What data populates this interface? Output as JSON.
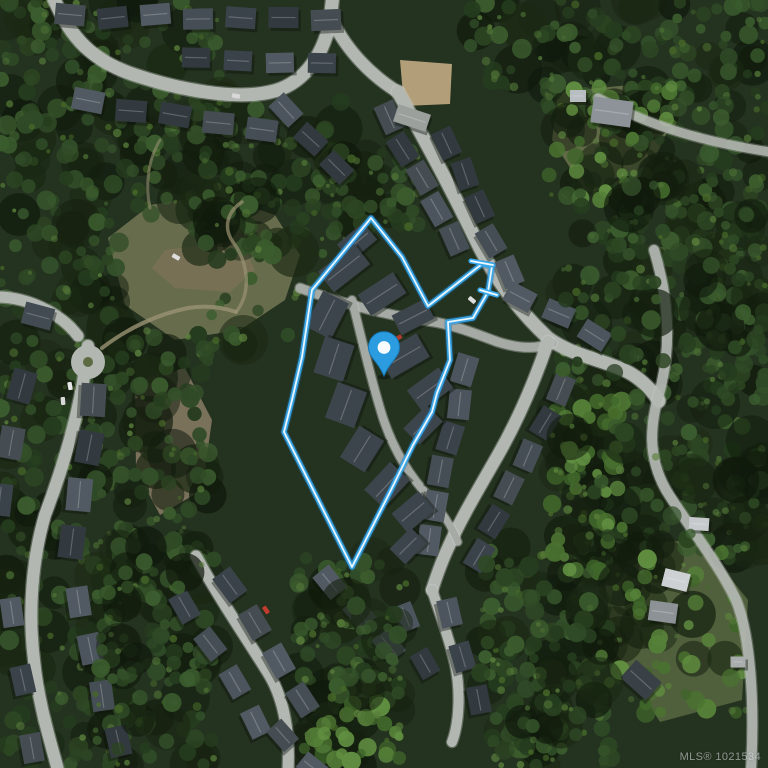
{
  "meta": {
    "width": 768,
    "height": 768,
    "view": "satellite"
  },
  "watermark": {
    "text": "MLS® 1021534"
  },
  "map": {
    "palette": {
      "forest_base": "#243220",
      "road": "#b3b7b2",
      "road_curb": "#d2d5d0",
      "lane": "#a6aaa5",
      "trail": "#9a9274",
      "boundary_outer": "#39a8ea",
      "boundary_halo": "#1d6fa8",
      "boundary_inner": "#f2fbff",
      "pin_fill": "#2b9ce0",
      "pin_stroke": "#1779b6",
      "pin_dot": "#ffffff"
    },
    "forest": {
      "dark_shades": [
        "#2c4522",
        "#34512a",
        "#253c1e",
        "#3b5c2e",
        "#2f4a26"
      ],
      "blob_shades": [
        "#15200f",
        "#1a2813",
        "#101a0c"
      ],
      "light_shades": [
        "#4d7034",
        "#5a7f3c",
        "#466828"
      ],
      "bright_shades": [
        "#4a7230",
        "#558038",
        "#3f652a",
        "#618f41"
      ],
      "regions": [
        {
          "x": 0,
          "y": 0,
          "w": 220,
          "h": 215,
          "n": 120,
          "p": "dark",
          "seed": 11
        },
        {
          "x": 195,
          "y": 95,
          "w": 150,
          "h": 165,
          "n": 70,
          "p": "dark",
          "seed": 12
        },
        {
          "x": 330,
          "y": 150,
          "w": 90,
          "h": 80,
          "n": 30,
          "p": "dark",
          "seed": 13
        },
        {
          "x": 470,
          "y": 0,
          "w": 298,
          "h": 110,
          "n": 90,
          "p": "dark",
          "seed": 14
        },
        {
          "x": 600,
          "y": 100,
          "w": 168,
          "h": 160,
          "n": 60,
          "p": "dark",
          "seed": 15
        },
        {
          "x": 560,
          "y": 170,
          "w": 208,
          "h": 390,
          "n": 170,
          "p": "dark",
          "seed": 16
        },
        {
          "x": 0,
          "y": 215,
          "w": 120,
          "h": 270,
          "n": 80,
          "p": "dark",
          "seed": 17
        },
        {
          "x": 120,
          "y": 330,
          "w": 90,
          "h": 230,
          "n": 55,
          "p": "dark",
          "seed": 18
        },
        {
          "x": 0,
          "y": 480,
          "w": 110,
          "h": 288,
          "n": 60,
          "p": "dark",
          "seed": 19
        },
        {
          "x": 95,
          "y": 540,
          "w": 120,
          "h": 228,
          "n": 85,
          "p": "dark",
          "seed": 20
        },
        {
          "x": 290,
          "y": 555,
          "w": 120,
          "h": 160,
          "n": 60,
          "p": "dark",
          "seed": 21
        },
        {
          "x": 480,
          "y": 545,
          "w": 140,
          "h": 223,
          "n": 90,
          "p": "dark",
          "seed": 22
        },
        {
          "x": 700,
          "y": 250,
          "w": 68,
          "h": 300,
          "n": 42,
          "p": "dark",
          "seed": 23
        },
        {
          "x": 200,
          "y": 190,
          "w": 120,
          "h": 160,
          "n": 22,
          "p": "dark",
          "seed": 24
        },
        {
          "x": 550,
          "y": 395,
          "w": 75,
          "h": 180,
          "n": 45,
          "p": "bright",
          "seed": 25
        },
        {
          "x": 300,
          "y": 700,
          "w": 100,
          "h": 68,
          "n": 26,
          "p": "bright",
          "seed": 26
        },
        {
          "x": 600,
          "y": 540,
          "w": 150,
          "h": 180,
          "n": 40,
          "p": "bright",
          "seed": 27
        },
        {
          "x": 545,
          "y": 80,
          "w": 130,
          "h": 120,
          "n": 28,
          "p": "bright",
          "seed": 28
        }
      ],
      "late_regions": [
        {
          "x": 560,
          "y": 180,
          "w": 200,
          "h": 360,
          "n": 40,
          "p": "dark",
          "seed": 31
        },
        {
          "x": 95,
          "y": 545,
          "w": 110,
          "h": 220,
          "n": 25,
          "p": "dark",
          "seed": 32
        },
        {
          "x": 480,
          "y": 560,
          "w": 130,
          "h": 200,
          "n": 30,
          "p": "dark",
          "seed": 33
        },
        {
          "x": 330,
          "y": 590,
          "w": 70,
          "h": 110,
          "n": 16,
          "p": "dark",
          "seed": 34
        }
      ]
    },
    "clearings": [
      {
        "points": "108,238 150,205 215,195 275,215 300,255 285,300 240,330 175,340 125,305",
        "fill": "#6e7150",
        "opacity": 0.92
      },
      {
        "points": "165,250 240,240 255,270 230,292 175,288 152,268",
        "fill": "#7c7257",
        "opacity": 0.75
      },
      {
        "points": "135,380 185,368 212,420 202,490 160,515 136,470",
        "fill": "#8a7d66",
        "opacity": 0.85
      },
      {
        "points": "600,545 700,540 748,600 742,700 660,722 614,650",
        "fill": "#5d6c43",
        "opacity": 0.8
      },
      {
        "points": "558,92 640,84 668,130 642,186 586,192 552,140",
        "fill": "#6b744d",
        "opacity": 0.85
      },
      {
        "points": "400,60 452,64 450,104 404,106",
        "fill": "#c2ab83",
        "opacity": 0.9
      }
    ],
    "trails": [
      {
        "d": "M 102,348 C 128,328 158,314 188,308 C 206,305 222,307 236,312",
        "w": 4,
        "o": 0.8
      },
      {
        "d": "M 236,312 C 252,292 248,262 233,242 C 223,228 227,212 242,202",
        "w": 3.5,
        "o": 0.7
      },
      {
        "d": "M 150,208 C 145,185 148,160 160,140",
        "w": 3,
        "o": 0.55
      }
    ],
    "roads": [
      {
        "d": "M 52,-6 C 70,40 95,62 135,75 C 180,90 235,100 270,92 C 300,86 322,60 330,22 L 333,-6",
        "w": 13
      },
      {
        "d": "M 333,22 C 348,52 372,76 398,92",
        "w": 12
      },
      {
        "d": "M 398,92 C 425,140 452,190 474,236 C 494,278 518,310 548,338 C 572,356 605,360 628,372 C 641,379 651,389 659,401",
        "w": 13
      },
      {
        "d": "M 300,288 C 345,305 392,316 428,321 C 452,324 476,334 498,342 C 520,349 538,349 552,343",
        "w": 9,
        "lane": true
      },
      {
        "d": "M 548,342 C 535,380 518,420 498,455 C 478,490 460,520 448,548 C 440,565 436,578 432,590",
        "w": 12
      },
      {
        "d": "M 432,590 C 440,614 449,638 455,664 C 461,692 459,724 452,742",
        "w": 10
      },
      {
        "d": "M 654,250 C 668,296 672,344 660,390 C 650,424 647,456 666,490 C 688,526 718,562 736,600 C 750,634 755,700 751,770",
        "w": 10,
        "o": 0.9
      },
      {
        "d": "M 598,98 C 642,122 692,140 770,152",
        "w": 9,
        "o": 0.85
      },
      {
        "d": "M 0,297 C 25,298 58,310 78,336",
        "w": 11
      },
      {
        "d": "M 88,346 C 82,408 62,470 45,515 C 32,560 28,612 34,660 C 38,702 50,740 58,770",
        "w": 12
      },
      {
        "d": "M 196,556 C 220,600 248,640 270,676 C 284,700 290,734 288,770",
        "w": 11
      },
      {
        "d": "M 352,300 C 362,340 371,380 383,418 C 393,448 409,476 431,499",
        "w": 8,
        "lane": true
      },
      {
        "d": "M 431,499 C 443,513 452,527 458,542",
        "w": 7,
        "lane": true
      }
    ],
    "culdesac": {
      "cx": 88,
      "cy": 362,
      "r": 17,
      "island_r": 5,
      "island_fill": "#5c6b42"
    },
    "roof_shades": [
      "#454e55",
      "#3a424a",
      "#515a62",
      "#454d52",
      "#32393f",
      "#4c555d"
    ],
    "house_rows": [
      {
        "a": [
          70,
          16
        ],
        "b": [
          326,
          20
        ],
        "n": 7,
        "w": 30,
        "h": 21
      },
      {
        "a": [
          196,
          56
        ],
        "b": [
          322,
          62
        ],
        "n": 4,
        "w": 28,
        "h": 20
      },
      {
        "a": [
          88,
          102
        ],
        "b": [
          262,
          128
        ],
        "n": 5,
        "w": 31,
        "h": 22
      },
      {
        "a": [
          284,
          112
        ],
        "b": [
          338,
          166
        ],
        "n": 3,
        "w": 29,
        "h": 21
      },
      {
        "a": [
          388,
          118
        ],
        "b": [
          452,
          240
        ],
        "n": 5,
        "w": 30,
        "h": 21
      },
      {
        "a": [
          447,
          143
        ],
        "b": [
          509,
          272
        ],
        "n": 5,
        "w": 29,
        "h": 21
      },
      {
        "a": [
          521,
          295
        ],
        "b": [
          594,
          336
        ],
        "n": 3,
        "w": 29,
        "h": 21
      },
      {
        "a": [
          466,
          370
        ],
        "b": [
          428,
          540
        ],
        "n": 6,
        "w": 30,
        "h": 22
      },
      {
        "a": [
          562,
          390
        ],
        "b": [
          478,
          555
        ],
        "n": 6,
        "w": 29,
        "h": 21
      },
      {
        "a": [
          452,
          612
        ],
        "b": [
          478,
          700
        ],
        "n": 3,
        "w": 28,
        "h": 21
      },
      {
        "a": [
          404,
          618
        ],
        "b": [
          424,
          664
        ],
        "n": 2,
        "w": 27,
        "h": 20
      },
      {
        "a": [
          328,
          584
        ],
        "b": [
          390,
          644
        ],
        "n": 3,
        "w": 29,
        "h": 21
      },
      {
        "a": [
          228,
          586
        ],
        "b": [
          302,
          700
        ],
        "n": 4,
        "w": 30,
        "h": 22
      },
      {
        "a": [
          186,
          606
        ],
        "b": [
          256,
          722
        ],
        "n": 4,
        "w": 29,
        "h": 21
      },
      {
        "a": [
          282,
          736
        ],
        "b": [
          314,
          766
        ],
        "n": 2,
        "w": 27,
        "h": 20
      },
      {
        "a": [
          94,
          400
        ],
        "b": [
          72,
          542
        ],
        "n": 4,
        "w": 33,
        "h": 25
      },
      {
        "a": [
          22,
          386
        ],
        "b": [
          2,
          500
        ],
        "n": 3,
        "w": 32,
        "h": 24
      },
      {
        "a": [
          78,
          602
        ],
        "b": [
          116,
          742
        ],
        "n": 4,
        "w": 30,
        "h": 22
      },
      {
        "a": [
          14,
          612
        ],
        "b": [
          32,
          748
        ],
        "n": 3,
        "w": 29,
        "h": 21
      }
    ],
    "townhouses": [
      {
        "c": [
          357,
          242
        ],
        "w": 34,
        "h": 22,
        "rot": -40
      },
      {
        "c": [
          344,
          268
        ],
        "w": 46,
        "h": 26,
        "rot": -38
      },
      {
        "c": [
          382,
          294
        ],
        "w": 42,
        "h": 25,
        "rot": -33
      },
      {
        "c": [
          413,
          317
        ],
        "w": 37,
        "h": 22,
        "rot": -27
      },
      {
        "c": [
          327,
          315
        ],
        "w": 40,
        "h": 29,
        "rot": -63
      },
      {
        "c": [
          334,
          359
        ],
        "w": 38,
        "h": 31,
        "rot": -72
      },
      {
        "c": [
          346,
          405
        ],
        "w": 38,
        "h": 31,
        "rot": -70
      },
      {
        "c": [
          362,
          449
        ],
        "w": 37,
        "h": 29,
        "rot": -58
      },
      {
        "c": [
          387,
          485
        ],
        "w": 38,
        "h": 27,
        "rot": -47
      },
      {
        "c": [
          413,
          512
        ],
        "w": 35,
        "h": 25,
        "rot": -40
      },
      {
        "c": [
          404,
          356
        ],
        "w": 44,
        "h": 27,
        "rot": -30
      },
      {
        "c": [
          430,
          389
        ],
        "w": 39,
        "h": 25,
        "rot": -36
      },
      {
        "c": [
          423,
          425
        ],
        "w": 33,
        "h": 23,
        "rot": -45
      },
      {
        "c": [
          408,
          546
        ],
        "w": 30,
        "h": 22,
        "rot": -45
      }
    ],
    "houses": [
      {
        "c": [
          612,
          112
        ],
        "w": 40,
        "h": 26,
        "rot": 8,
        "fill": "#8e9399"
      },
      {
        "c": [
          578,
          96
        ],
        "w": 16,
        "h": 12,
        "rot": 0,
        "fill": "#b9bec2"
      },
      {
        "c": [
          676,
          580
        ],
        "w": 26,
        "h": 18,
        "rot": 14,
        "fill": "#cdd1d4"
      },
      {
        "c": [
          663,
          612
        ],
        "w": 28,
        "h": 20,
        "rot": 8,
        "fill": "#8d9296"
      },
      {
        "c": [
          641,
          680
        ],
        "w": 34,
        "h": 24,
        "rot": 42,
        "fill": "#394046"
      },
      {
        "c": [
          699,
          524
        ],
        "w": 20,
        "h": 13,
        "rot": 4,
        "fill": "#c6cacc"
      },
      {
        "c": [
          738,
          662
        ],
        "w": 15,
        "h": 11,
        "rot": 0,
        "fill": "#a9adad"
      },
      {
        "c": [
          38,
          316
        ],
        "w": 30,
        "h": 22,
        "rot": 15,
        "fill": "#424b52"
      },
      {
        "c": [
          412,
          118
        ],
        "w": 34,
        "h": 18,
        "rot": 18,
        "fill": "#9ba09c"
      }
    ],
    "cars": [
      {
        "c": [
          70,
          386
        ],
        "rot": 80,
        "fill": "#e6e6e6"
      },
      {
        "c": [
          63,
          401
        ],
        "rot": 85,
        "fill": "#d8d8d8"
      },
      {
        "c": [
          176,
          257
        ],
        "rot": 30,
        "fill": "#dddddd"
      },
      {
        "c": [
          398,
          338
        ],
        "rot": -30,
        "fill": "#b03a2e"
      },
      {
        "c": [
          472,
          300
        ],
        "rot": 40,
        "fill": "#dddddd"
      },
      {
        "c": [
          236,
          96
        ],
        "rot": 10,
        "fill": "#d8d8d8"
      },
      {
        "c": [
          266,
          610
        ],
        "rot": 55,
        "fill": "#c23b2e"
      }
    ],
    "boundary": {
      "points": [
        [
          371,
          218
        ],
        [
          402,
          257
        ],
        [
          428,
          306
        ],
        [
          482,
          264
        ],
        [
          492,
          266
        ],
        [
          488,
          292
        ],
        [
          473,
          318
        ],
        [
          448,
          322
        ],
        [
          450,
          360
        ],
        [
          437,
          393
        ],
        [
          432,
          412
        ],
        [
          413,
          445
        ],
        [
          391,
          490
        ],
        [
          352,
          567
        ],
        [
          284,
          432
        ],
        [
          292,
          400
        ],
        [
          302,
          357
        ],
        [
          312,
          290
        ]
      ],
      "caps": [
        [
          [
            471,
            261
          ],
          [
            493,
            265
          ]
        ],
        [
          [
            480,
            290
          ],
          [
            497,
            295
          ]
        ]
      ],
      "halo_width": 7.5,
      "outer_width": 5.2,
      "inner_width": 1.8
    },
    "pin": {
      "x": 384,
      "y": 376
    }
  }
}
